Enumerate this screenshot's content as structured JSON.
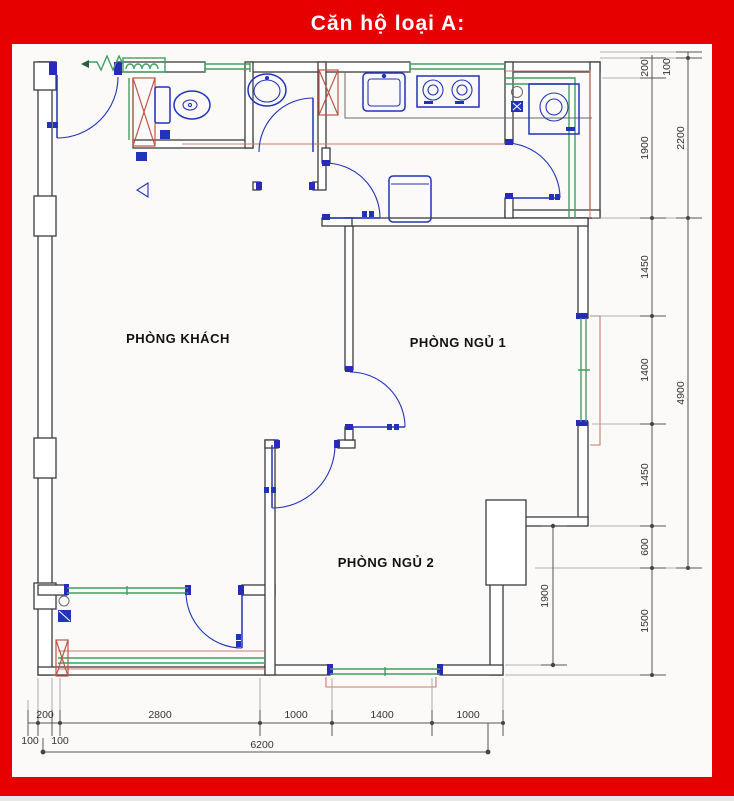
{
  "header": {
    "title": "Căn hộ loại A:"
  },
  "rooms": [
    {
      "name": "PHÒNG KHÁCH"
    },
    {
      "name": "PHÒNG NGỦ 1"
    },
    {
      "name": "PHÒNG NGỦ 2"
    }
  ],
  "dims": {
    "right_inner": [
      "200",
      "1900",
      "1450",
      "1400",
      "1450",
      "600",
      "1500"
    ],
    "right_outer": [
      "100",
      "2200",
      "4900"
    ],
    "bottom": [
      "100",
      "200",
      "100",
      "2800",
      "1000",
      "1400",
      "1000"
    ],
    "bottom_total": "6200",
    "interior_vertical": "1900"
  },
  "fixtures": [
    "toilet",
    "wash-basin",
    "kitchen-sink",
    "stove",
    "fridge",
    "washing-machine"
  ],
  "colors": {
    "frame": "#e60000",
    "walls": "#3c3c3c",
    "fixtures_blue": "#2233bb",
    "windows_green": "#3fa060",
    "shaft_red": "#c05545",
    "dimension_text": "#333333",
    "title_text": "#ffffff"
  }
}
